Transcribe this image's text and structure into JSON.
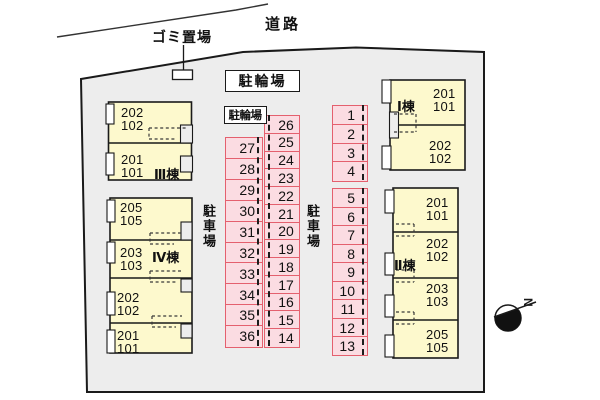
{
  "labels": {
    "road": "道路",
    "garbage": "ゴミ置場",
    "bicycle_parking_main": "駐輪場",
    "bicycle_parking_small": "駐輪場",
    "car_parking_left": "駐車場",
    "car_parking_right": "駐車場",
    "compass": "N"
  },
  "buildings": [
    {
      "id": "bldg-3",
      "label": "Ⅲ棟",
      "units": [
        "202\n102",
        "201\n101"
      ]
    },
    {
      "id": "bldg-4",
      "label": "Ⅳ棟",
      "units": [
        "205\n105",
        "203\n103",
        "202\n102",
        "201\n101"
      ]
    },
    {
      "id": "bldg-1",
      "label": "Ⅰ棟",
      "units": [
        "201\n101",
        "202\n102"
      ]
    },
    {
      "id": "bldg-2",
      "label": "Ⅱ棟",
      "units": [
        "201\n101",
        "202\n102",
        "203\n103",
        "205\n105"
      ]
    }
  ],
  "parking_stalls": {
    "column_left": [
      27,
      28,
      29,
      30,
      31,
      32,
      33,
      34,
      35,
      36
    ],
    "column_middle": [
      26,
      25,
      24,
      23,
      22,
      21,
      20,
      19,
      18,
      17,
      16,
      15,
      14
    ],
    "column_right_top": [
      1,
      2,
      3,
      4
    ],
    "column_right_bottom": [
      5,
      6,
      7,
      8,
      9,
      10,
      11,
      12,
      13
    ]
  },
  "colors": {
    "site_fill": "#ededed",
    "building_fill": "#fdf9cd",
    "stall_fill": "#fbdce2",
    "stall_border": "#e4606e",
    "outline": "#1a1a1a"
  }
}
